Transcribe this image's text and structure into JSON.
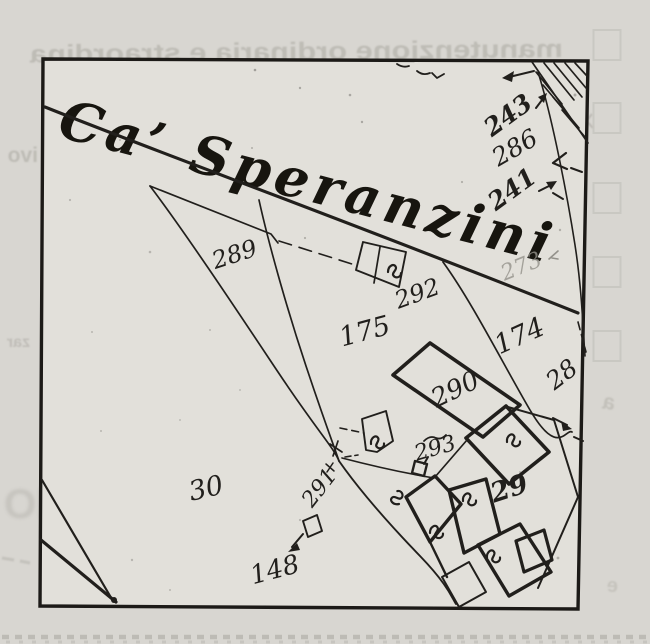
{
  "map": {
    "title": "Ca’ Speranzini",
    "labels": [
      {
        "text": "243",
        "x": 513,
        "y": 122,
        "rot": -36,
        "size": 25,
        "weight": "bold"
      },
      {
        "text": "286",
        "x": 519,
        "y": 155,
        "rot": -30,
        "size": 25,
        "weight": "normal"
      },
      {
        "text": "241",
        "x": 517,
        "y": 196,
        "rot": -36,
        "size": 25,
        "weight": "bold"
      },
      {
        "text": "273",
        "x": 524,
        "y": 273,
        "rot": -22,
        "size": 22,
        "weight": "normal",
        "faded": true
      },
      {
        "text": "289",
        "x": 237,
        "y": 262,
        "rot": -18,
        "size": 24,
        "weight": "normal"
      },
      {
        "text": "292",
        "x": 420,
        "y": 301,
        "rot": -20,
        "size": 24,
        "weight": "normal"
      },
      {
        "text": "175",
        "x": 367,
        "y": 340,
        "rot": -15,
        "size": 27,
        "weight": "normal"
      },
      {
        "text": "174",
        "x": 523,
        "y": 344,
        "rot": -24,
        "size": 27,
        "weight": "normal"
      },
      {
        "text": "28",
        "x": 567,
        "y": 381,
        "rot": -38,
        "size": 25,
        "weight": "normal"
      },
      {
        "text": "290",
        "x": 459,
        "y": 397,
        "rot": -26,
        "size": 26,
        "weight": "normal"
      },
      {
        "text": "293",
        "x": 437,
        "y": 455,
        "rot": -16,
        "size": 22,
        "weight": "normal"
      },
      {
        "text": "291",
        "x": 325,
        "y": 492,
        "rot": -52,
        "size": 22,
        "weight": "normal"
      },
      {
        "text": "29",
        "x": 512,
        "y": 497,
        "rot": -18,
        "size": 27,
        "weight": "bold"
      },
      {
        "text": "30",
        "x": 208,
        "y": 497,
        "rot": -13,
        "size": 27,
        "weight": "normal"
      },
      {
        "text": "148",
        "x": 277,
        "y": 578,
        "rot": -15,
        "size": 26,
        "weight": "normal"
      }
    ]
  },
  "bleedthrough": {
    "top_text": "manutenzione ordinaria e straordina",
    "left_text_1": "ivo",
    "left_text_2": "zar",
    "left_text_3": "IO",
    "right_mark_1": "a",
    "right_mark_2": "e"
  },
  "margin": {
    "checkbox_ys": [
      30,
      103,
      183,
      257,
      331
    ]
  },
  "colors": {
    "ink": "#211f1c",
    "faded_ink": "#94928b",
    "paper_outside": "#d8d6d1",
    "paper_inside": "#e2e0da",
    "bleed_gray": "#a5a39c",
    "checkbox_gray": "#c6c4be"
  }
}
